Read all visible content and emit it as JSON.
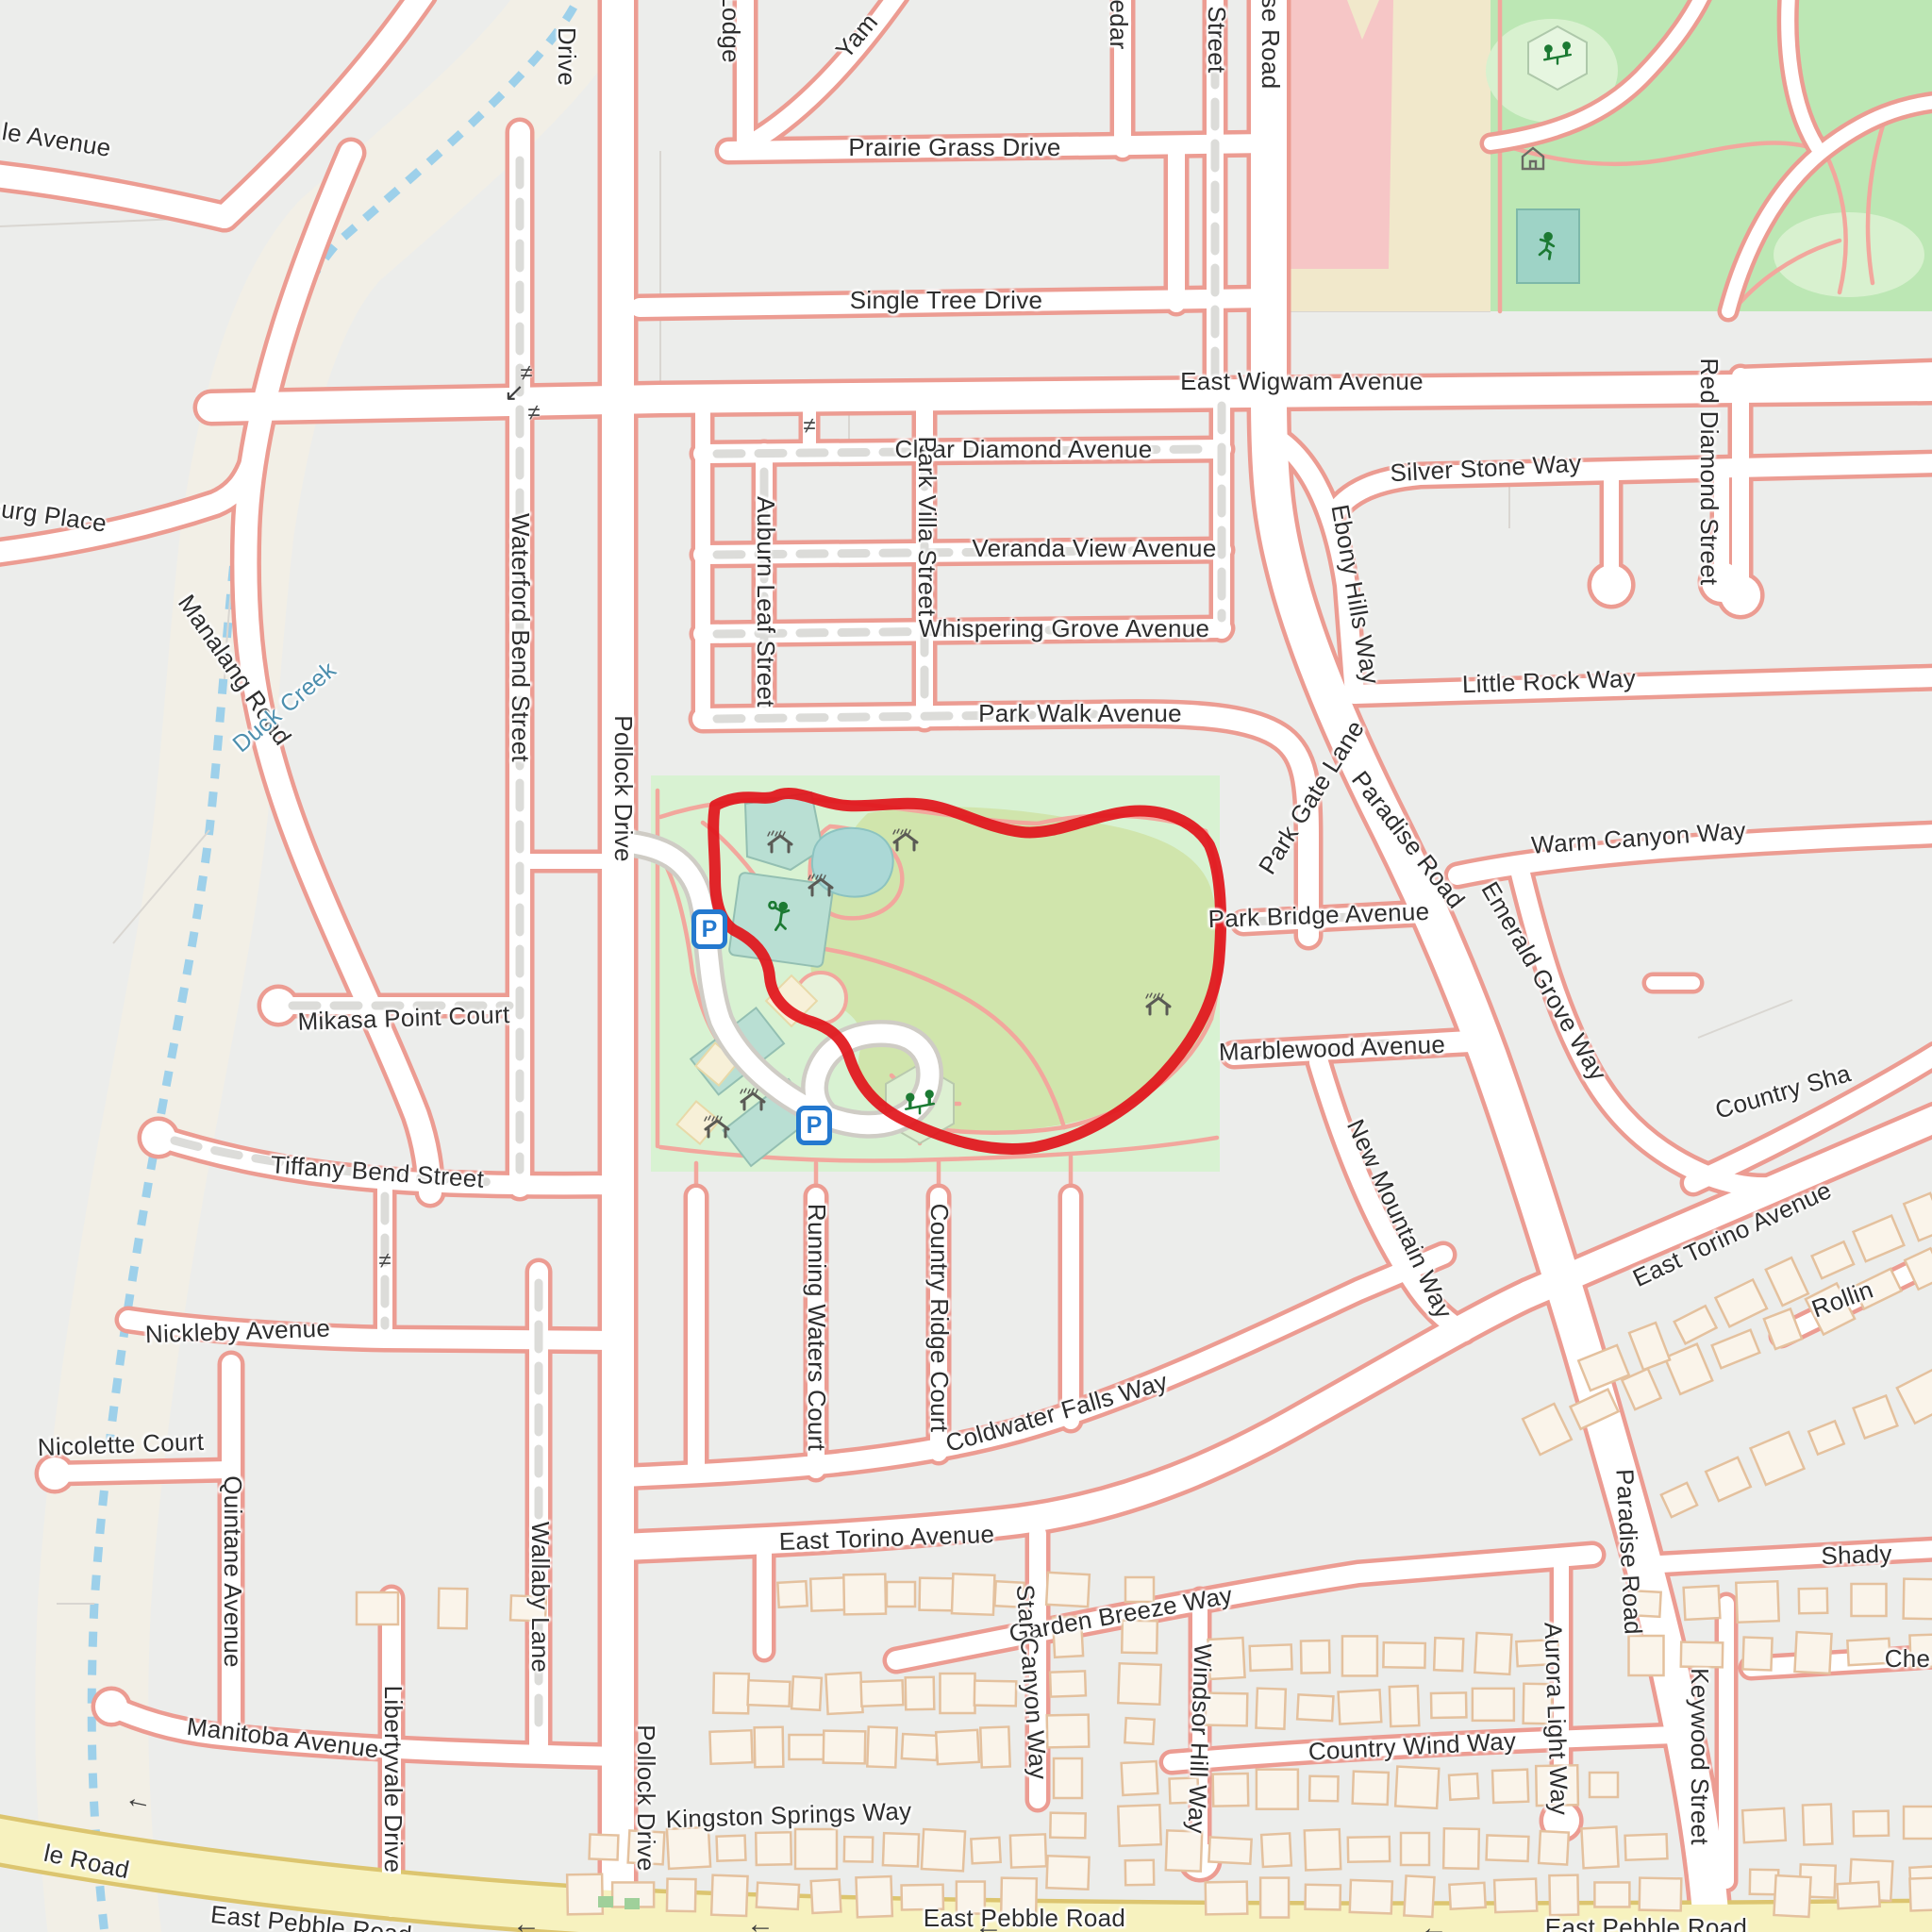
{
  "map": {
    "description": "Residential street map with central park and red running route loop",
    "style": "openstreetmap-like",
    "colors": {
      "background": "#ecedeb",
      "road_fill": "#ffffff",
      "road_sidewalk_casing": "#ec9c92",
      "park_green": "#d8f2d2",
      "meadow_green": "#d0e5ac",
      "sport_pitch_teal": "#b9dfd3",
      "pond_teal": "#abd8d6",
      "school_tan": "#f1e8cb",
      "school_building_pink": "#f6c6c6",
      "ne_park_green": "#bce7b4",
      "creek_band": "#f2efe6",
      "creek_water_dash": "#9dd0ea",
      "main_road_yellow": "#f7f2bf",
      "route_red": "#e1151c",
      "parking_blue": "#2479cf",
      "icon_green": "#1c7a33",
      "house_fill": "#faf4ea",
      "house_stroke": "#e4c19e"
    },
    "route": {
      "type": "gps-trace-loop",
      "color": "#e1151c",
      "location": "around central park"
    }
  },
  "glyphs": {
    "gate": "≠",
    "one_way_left": "←",
    "one_way_sw": "↙",
    "parking": "P"
  },
  "icons": {
    "picnic_shelter": "roof-with-rain-marks",
    "tennis_player": "green-figure-with-racket",
    "playground": "two-figures-on-seesaw",
    "basketball_player": "green-running-figure",
    "house": "hut-outline",
    "parking": "blue-P-square"
  },
  "labels": [
    {
      "text": "le Avenue"
    },
    {
      "text": "Drive"
    },
    {
      "text": "Lodge"
    },
    {
      "text": "Yam"
    },
    {
      "text": "Prairie Grass Drive"
    },
    {
      "text": "Single Tree Drive"
    },
    {
      "text": "edar"
    },
    {
      "text": "Street"
    },
    {
      "text": "se Road"
    },
    {
      "text": "East Wigwam Avenue"
    },
    {
      "text": "Clear Diamond Avenue"
    },
    {
      "text": "Veranda View Avenue"
    },
    {
      "text": "Whispering Grove Avenue"
    },
    {
      "text": "Park Walk Avenue"
    },
    {
      "text": "Park Gate Lane"
    },
    {
      "text": "Paradise Road"
    },
    {
      "text": "Park Bridge Avenue"
    },
    {
      "text": "Ebony Hills Way"
    },
    {
      "text": "Silver Stone Way"
    },
    {
      "text": "Red Diamond Street"
    },
    {
      "text": "Little Rock Way"
    },
    {
      "text": "Warm Canyon Way"
    },
    {
      "text": "Emerald Grove Way"
    },
    {
      "text": "Country Sha"
    },
    {
      "text": "Marblewood Avenue"
    },
    {
      "text": "New Mountain Way"
    },
    {
      "text": "East Torino Avenue"
    },
    {
      "text": "Rollin"
    },
    {
      "text": "Paradise Road"
    },
    {
      "text": "Shady"
    },
    {
      "text": "Che"
    },
    {
      "text": "Keywood Street"
    },
    {
      "text": "Aurora Light Way"
    },
    {
      "text": "Country Wind Way"
    },
    {
      "text": "Windsor Hill Way"
    },
    {
      "text": "Garden Breeze Way"
    },
    {
      "text": "Star Canyon Way"
    },
    {
      "text": "East Torino Avenue"
    },
    {
      "text": "Kingston Springs Way"
    },
    {
      "text": "Coldwater Falls Way"
    },
    {
      "text": "Running Waters Court"
    },
    {
      "text": "Country Ridge Court"
    },
    {
      "text": "Pollock Drive"
    },
    {
      "text": "Pollock Drive"
    },
    {
      "text": "Waterford Bend Street"
    },
    {
      "text": "Auburn Leaf Street"
    },
    {
      "text": "Park Villa Street"
    },
    {
      "text": "Manalang Road"
    },
    {
      "text": "Duck Creek"
    },
    {
      "text": "burg Place"
    },
    {
      "text": "Mikasa Point Court"
    },
    {
      "text": "Tiffany Bend Street"
    },
    {
      "text": "Nickleby Avenue"
    },
    {
      "text": "Nicolette Court"
    },
    {
      "text": "Quintane Avenue"
    },
    {
      "text": "Manitoba Avenue"
    },
    {
      "text": "Libertyvale Drive"
    },
    {
      "text": "Wallaby Lane"
    },
    {
      "text": "le Road"
    },
    {
      "text": "East Pebble Road"
    },
    {
      "text": "East Pebble Road"
    },
    {
      "text": "East Pebble Road"
    }
  ]
}
